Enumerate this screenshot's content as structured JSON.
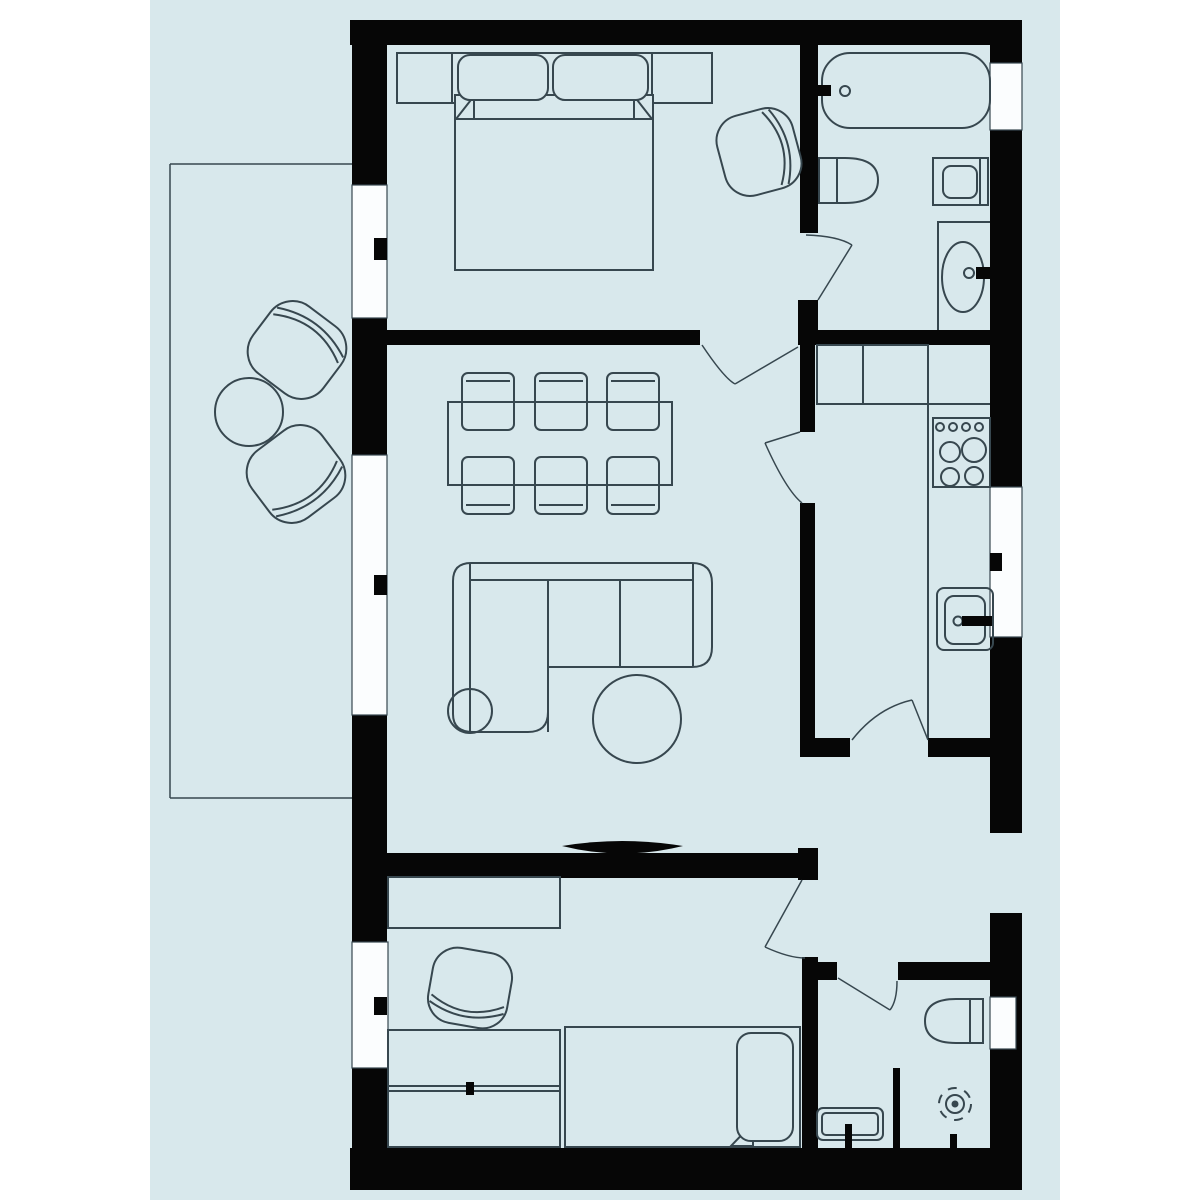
{
  "canvas": {
    "width": 1200,
    "height": 1200,
    "background": "#ffffff"
  },
  "palette": {
    "floor": "#d8e8ec",
    "wall": "#060606",
    "line": "#37474f",
    "window": "#fbfdfe",
    "stroke_furniture": 2,
    "stroke_frame": 1.5
  },
  "plan": {
    "floor_panel": {
      "x": 150,
      "y": 0,
      "w": 910,
      "h": 1200
    },
    "balcony": {
      "lines": [
        {
          "name": "balcony-edge-top",
          "x1": 170,
          "y1": 164,
          "x2": 352,
          "y2": 164
        },
        {
          "name": "balcony-edge-left",
          "x1": 170,
          "y1": 164,
          "x2": 170,
          "y2": 798
        },
        {
          "name": "balcony-edge-bottom",
          "x1": 170,
          "y1": 798,
          "x2": 352,
          "y2": 798
        }
      ]
    },
    "walls": [
      {
        "name": "wall-top",
        "x": 350,
        "y": 20,
        "w": 672,
        "h": 25
      },
      {
        "name": "wall-left-1",
        "x": 352,
        "y": 20,
        "w": 35,
        "h": 165
      },
      {
        "name": "wall-left-2",
        "x": 352,
        "y": 318,
        "w": 35,
        "h": 137
      },
      {
        "name": "wall-left-3",
        "x": 352,
        "y": 715,
        "w": 35,
        "h": 227
      },
      {
        "name": "wall-left-4",
        "x": 352,
        "y": 1068,
        "w": 36,
        "h": 92
      },
      {
        "name": "wall-bottom",
        "x": 350,
        "y": 1148,
        "w": 672,
        "h": 42
      },
      {
        "name": "wall-right-1",
        "x": 990,
        "y": 20,
        "w": 32,
        "h": 43
      },
      {
        "name": "wall-right-2",
        "x": 990,
        "y": 130,
        "w": 32,
        "h": 357
      },
      {
        "name": "wall-right-3",
        "x": 990,
        "y": 637,
        "w": 32,
        "h": 196
      },
      {
        "name": "wall-right-4",
        "x": 990,
        "y": 913,
        "w": 32,
        "h": 245
      },
      {
        "name": "wall-bedroom1-bathroom1",
        "x": 800,
        "y": 45,
        "w": 18,
        "h": 188
      },
      {
        "name": "wall-junction-block",
        "x": 798,
        "y": 300,
        "w": 20,
        "h": 45
      },
      {
        "name": "wall-livingroom-top",
        "x": 387,
        "y": 330,
        "w": 313,
        "h": 15
      },
      {
        "name": "wall-bathroom1-bottom",
        "x": 815,
        "y": 330,
        "w": 175,
        "h": 15
      },
      {
        "name": "wall-kitchen-left-upper",
        "x": 800,
        "y": 345,
        "w": 15,
        "h": 87
      },
      {
        "name": "wall-kitchen-left-lower",
        "x": 800,
        "y": 503,
        "w": 15,
        "h": 254
      },
      {
        "name": "wall-kitchen-bottom-left",
        "x": 800,
        "y": 738,
        "w": 50,
        "h": 19
      },
      {
        "name": "wall-kitchen-bottom-right",
        "x": 928,
        "y": 738,
        "w": 62,
        "h": 19
      },
      {
        "name": "wall-livingroom-bottom",
        "x": 387,
        "y": 853,
        "w": 416,
        "h": 25
      },
      {
        "name": "wall-livingroom-bottom-cap",
        "x": 798,
        "y": 848,
        "w": 20,
        "h": 32
      },
      {
        "name": "wall-bedroom2-right",
        "x": 802,
        "y": 957,
        "w": 16,
        "h": 191
      },
      {
        "name": "wall-bathroom2-top-left",
        "x": 817,
        "y": 962,
        "w": 20,
        "h": 18
      },
      {
        "name": "wall-bathroom2-top-right",
        "x": 898,
        "y": 962,
        "w": 92,
        "h": 18
      },
      {
        "name": "wall-bathroom2-partition",
        "x": 893,
        "y": 1068,
        "w": 7,
        "h": 80
      }
    ],
    "windows": [
      {
        "name": "window-bedroom1-left",
        "x": 352,
        "y": 185,
        "w": 35,
        "h": 133,
        "tick": {
          "x": 374,
          "y": 238,
          "w": 13,
          "h": 22
        }
      },
      {
        "name": "window-livingroom-left",
        "x": 352,
        "y": 455,
        "w": 35,
        "h": 260,
        "tick": {
          "x": 374,
          "y": 575,
          "w": 13,
          "h": 20
        }
      },
      {
        "name": "window-bedroom2-left",
        "x": 352,
        "y": 942,
        "w": 36,
        "h": 126,
        "tick": {
          "x": 374,
          "y": 997,
          "w": 13,
          "h": 18
        }
      },
      {
        "name": "window-bathroom1-right",
        "x": 990,
        "y": 63,
        "w": 32,
        "h": 67,
        "tick": null
      },
      {
        "name": "window-kitchen-right",
        "x": 990,
        "y": 487,
        "w": 32,
        "h": 150,
        "tick": {
          "x": 990,
          "y": 553,
          "w": 12,
          "h": 18
        }
      },
      {
        "name": "niche-toilet-bathroom2",
        "x": 990,
        "y": 997,
        "w": 26,
        "h": 52,
        "tick": null
      }
    ],
    "doors": [
      {
        "name": "door-bedroom1",
        "leaf": [
          798,
          347,
          735,
          384
        ],
        "arc": "M702 345 Q724 378 735 384"
      },
      {
        "name": "door-bathroom1",
        "leaf": [
          818,
          300,
          852,
          245
        ],
        "arc": "M806 235 Q838 236 852 245"
      },
      {
        "name": "door-kitchen-living",
        "leaf": [
          800,
          432,
          765,
          443
        ],
        "arc": "M765 443 Q786 490 802 503"
      },
      {
        "name": "door-kitchen-hallway",
        "leaf": [
          928,
          740,
          912,
          700
        ],
        "arc": "M852 740 Q877 708 912 700"
      },
      {
        "name": "door-bedroom2",
        "leaf": [
          802,
          880,
          765,
          947
        ],
        "arc": "M765 947 Q789 958 805 958"
      },
      {
        "name": "door-bathroom2",
        "leaf": [
          838,
          978,
          890,
          1010
        ],
        "arc": "M897 981 Q897 1001 890 1010"
      }
    ],
    "furniture": [
      {
        "name": "balcony-armchair-top",
        "type": "tubchair",
        "cx": 297,
        "cy": 350,
        "w": 84,
        "h": 88,
        "rot": -53
      },
      {
        "name": "balcony-armchair-bottom",
        "type": "tubchair",
        "cx": 296,
        "cy": 474,
        "w": 84,
        "h": 88,
        "rot": 53
      },
      {
        "name": "balcony-table",
        "type": "circle",
        "cx": 249,
        "cy": 412,
        "r": 34
      },
      {
        "name": "wardrobe-bedroom1",
        "type": "rect",
        "x": 397,
        "y": 53,
        "w": 315,
        "h": 50
      },
      {
        "name": "wardrobe-bedroom1-divider-1",
        "type": "line",
        "x1": 452,
        "y1": 53,
        "x2": 452,
        "y2": 103
      },
      {
        "name": "wardrobe-bedroom1-divider-2",
        "type": "line",
        "x1": 652,
        "y1": 53,
        "x2": 652,
        "y2": 103
      },
      {
        "name": "double-bed",
        "type": "rectf",
        "x": 455,
        "y": 95,
        "w": 198,
        "h": 175
      },
      {
        "name": "double-bed-blanket-line",
        "type": "line",
        "x1": 455,
        "y1": 119,
        "x2": 653,
        "y2": 119
      },
      {
        "name": "double-bed-fold-left",
        "type": "polygon",
        "points": "456,119 474,96 474,119"
      },
      {
        "name": "double-bed-fold-right",
        "type": "polygon",
        "points": "652,119 634,96 634,119"
      },
      {
        "name": "double-bed-pillow-1",
        "type": "rrectf",
        "x": 458,
        "y": 55,
        "w": 90,
        "h": 45,
        "rx": 12
      },
      {
        "name": "double-bed-pillow-2",
        "type": "rrectf",
        "x": 553,
        "y": 55,
        "w": 95,
        "h": 45,
        "rx": 12
      },
      {
        "name": "bedroom1-armchair",
        "type": "tubchair",
        "cx": 759,
        "cy": 152,
        "w": 78,
        "h": 82,
        "rot": -15
      },
      {
        "name": "bathtub",
        "type": "rrect",
        "x": 822,
        "y": 53,
        "w": 168,
        "h": 75,
        "rx": 28
      },
      {
        "name": "bathtub-faucet",
        "type": "blackrect",
        "x": 815,
        "y": 85,
        "w": 16,
        "h": 11
      },
      {
        "name": "bathtub-faucet-knob",
        "type": "circle",
        "cx": 845,
        "cy": 91,
        "r": 5
      },
      {
        "name": "toilet-bathroom1",
        "type": "path",
        "d": "M819 158 L845 158 Q878 158 878 180 Q878 203 845 203 L819 203 Z"
      },
      {
        "name": "toilet-bathroom1-cistern-line",
        "type": "line",
        "x1": 837,
        "y1": 158,
        "x2": 837,
        "y2": 203
      },
      {
        "name": "washbasin-small",
        "type": "rect",
        "x": 933,
        "y": 158,
        "w": 55,
        "h": 47
      },
      {
        "name": "washbasin-small-bowl",
        "type": "rrect",
        "x": 943,
        "y": 166,
        "w": 34,
        "h": 32,
        "rx": 8
      },
      {
        "name": "washbasin-small-line",
        "type": "line",
        "x1": 980,
        "y1": 158,
        "x2": 980,
        "y2": 205
      },
      {
        "name": "vanity-counter",
        "type": "path",
        "d": "M938 330 L938 222 L990 222"
      },
      {
        "name": "vanity-sink",
        "type": "ellipse",
        "cx": 963,
        "cy": 277,
        "rx": 21,
        "ry": 35
      },
      {
        "name": "vanity-faucet",
        "type": "blackrect",
        "x": 976,
        "y": 267,
        "w": 16,
        "h": 12
      },
      {
        "name": "vanity-faucet-knob",
        "type": "circle",
        "cx": 969,
        "cy": 273,
        "r": 5
      },
      {
        "name": "kitchen-cabinets",
        "type": "rect",
        "x": 817,
        "y": 345,
        "w": 111,
        "h": 59
      },
      {
        "name": "kitchen-cabinet-divider",
        "type": "line",
        "x1": 863,
        "y1": 345,
        "x2": 863,
        "y2": 404
      },
      {
        "name": "kitchen-counter-edge",
        "type": "line",
        "x1": 928,
        "y1": 345,
        "x2": 928,
        "y2": 738
      },
      {
        "name": "kitchen-counter-top-line",
        "type": "line",
        "x1": 928,
        "y1": 404,
        "x2": 990,
        "y2": 404
      },
      {
        "name": "stove",
        "type": "rect",
        "x": 933,
        "y": 418,
        "w": 57,
        "h": 69
      },
      {
        "name": "stove-knob-1",
        "type": "circle",
        "cx": 940,
        "cy": 427,
        "r": 4
      },
      {
        "name": "stove-knob-2",
        "type": "circle",
        "cx": 953,
        "cy": 427,
        "r": 4
      },
      {
        "name": "stove-knob-3",
        "type": "circle",
        "cx": 966,
        "cy": 427,
        "r": 4
      },
      {
        "name": "stove-knob-4",
        "type": "circle",
        "cx": 979,
        "cy": 427,
        "r": 4
      },
      {
        "name": "stove-burner-1",
        "type": "circle",
        "cx": 950,
        "cy": 452,
        "r": 10
      },
      {
        "name": "stove-burner-2",
        "type": "circle",
        "cx": 974,
        "cy": 450,
        "r": 12
      },
      {
        "name": "stove-burner-3",
        "type": "circle",
        "cx": 950,
        "cy": 477,
        "r": 9
      },
      {
        "name": "stove-burner-4",
        "type": "circle",
        "cx": 974,
        "cy": 476,
        "r": 9
      },
      {
        "name": "kitchen-sink",
        "type": "rrect",
        "x": 937,
        "y": 588,
        "w": 56,
        "h": 62,
        "rx": 7
      },
      {
        "name": "kitchen-sink-basin",
        "type": "rrect",
        "x": 945,
        "y": 596,
        "w": 40,
        "h": 48,
        "rx": 9
      },
      {
        "name": "kitchen-faucet-knob",
        "type": "circle",
        "cx": 958,
        "cy": 621,
        "r": 4.5
      },
      {
        "name": "kitchen-faucet",
        "type": "blackrect",
        "x": 962,
        "y": 616,
        "w": 30,
        "h": 10
      },
      {
        "name": "dining-chair-top-1",
        "type": "rrect",
        "x": 462,
        "y": 373,
        "w": 52,
        "h": 57,
        "rx": 6
      },
      {
        "name": "dining-chair-top-1-back",
        "type": "line",
        "x1": 466,
        "y1": 381,
        "x2": 510,
        "y2": 381
      },
      {
        "name": "dining-chair-top-2",
        "type": "rrect",
        "x": 535,
        "y": 373,
        "w": 52,
        "h": 57,
        "rx": 6
      },
      {
        "name": "dining-chair-top-2-back",
        "type": "line",
        "x1": 539,
        "y1": 381,
        "x2": 583,
        "y2": 381
      },
      {
        "name": "dining-chair-top-3",
        "type": "rrect",
        "x": 607,
        "y": 373,
        "w": 52,
        "h": 57,
        "rx": 6
      },
      {
        "name": "dining-chair-top-3-back",
        "type": "line",
        "x1": 611,
        "y1": 381,
        "x2": 655,
        "y2": 381
      },
      {
        "name": "dining-chair-bottom-1",
        "type": "rrect",
        "x": 462,
        "y": 457,
        "w": 52,
        "h": 57,
        "rx": 6
      },
      {
        "name": "dining-chair-bottom-1-back",
        "type": "line",
        "x1": 466,
        "y1": 505,
        "x2": 510,
        "y2": 505
      },
      {
        "name": "dining-chair-bottom-2",
        "type": "rrect",
        "x": 535,
        "y": 457,
        "w": 52,
        "h": 57,
        "rx": 6
      },
      {
        "name": "dining-chair-bottom-2-back",
        "type": "line",
        "x1": 539,
        "y1": 505,
        "x2": 583,
        "y2": 505
      },
      {
        "name": "dining-chair-bottom-3",
        "type": "rrect",
        "x": 607,
        "y": 457,
        "w": 52,
        "h": 57,
        "rx": 6
      },
      {
        "name": "dining-chair-bottom-3-back",
        "type": "line",
        "x1": 611,
        "y1": 505,
        "x2": 655,
        "y2": 505
      },
      {
        "name": "dining-table",
        "type": "rect",
        "x": 448,
        "y": 402,
        "w": 224,
        "h": 83
      },
      {
        "name": "sofa-outline",
        "type": "pathf",
        "d": "M453 714 L453 581 Q453 563 471 563 L692 563 Q712 563 712 583 L712 647 Q712 667 692 667 L548 667 L548 712 Q548 732 528 732 L473 732 Q453 732 453 714 Z"
      },
      {
        "name": "sofa-back-line",
        "type": "line",
        "x1": 470,
        "y1": 580,
        "x2": 693,
        "y2": 580
      },
      {
        "name": "sofa-left-arm-line",
        "type": "line",
        "x1": 470,
        "y1": 563,
        "x2": 470,
        "y2": 732
      },
      {
        "name": "sofa-chaise-edge",
        "type": "line",
        "x1": 548,
        "y1": 580,
        "x2": 548,
        "y2": 732
      },
      {
        "name": "sofa-cushion-divider",
        "type": "line",
        "x1": 620,
        "y1": 580,
        "x2": 620,
        "y2": 667
      },
      {
        "name": "sofa-right-arm-line",
        "type": "line",
        "x1": 693,
        "y1": 563,
        "x2": 693,
        "y2": 667
      },
      {
        "name": "side-table",
        "type": "circle",
        "cx": 470,
        "cy": 711,
        "r": 22
      },
      {
        "name": "coffee-table",
        "type": "circle",
        "cx": 637,
        "cy": 719,
        "r": 44
      },
      {
        "name": "tv",
        "type": "blackpath",
        "d": "M562 846 Q622 836 683 846 Q622 861 562 846 Z"
      },
      {
        "name": "tv-stand",
        "type": "blackrect",
        "x": 618,
        "y": 851,
        "w": 12,
        "h": 15
      },
      {
        "name": "desk-bedroom2",
        "type": "rect",
        "x": 388,
        "y": 877,
        "w": 172,
        "h": 51
      },
      {
        "name": "bedroom2-armchair",
        "type": "tubchair",
        "cx": 470,
        "cy": 988,
        "w": 76,
        "h": 80,
        "rot": 100
      },
      {
        "name": "wardrobe-bedroom2",
        "type": "rect",
        "x": 388,
        "y": 1030,
        "w": 172,
        "h": 117
      },
      {
        "name": "wardrobe-bedroom2-line-1",
        "type": "line",
        "x1": 388,
        "y1": 1086,
        "x2": 560,
        "y2": 1086
      },
      {
        "name": "wardrobe-bedroom2-line-2",
        "type": "line",
        "x1": 388,
        "y1": 1091,
        "x2": 560,
        "y2": 1091
      },
      {
        "name": "wardrobe-bedroom2-handle",
        "type": "blackrect",
        "x": 466,
        "y": 1082,
        "w": 8,
        "h": 13
      },
      {
        "name": "single-bed",
        "type": "rectf",
        "x": 565,
        "y": 1027,
        "w": 235,
        "h": 120
      },
      {
        "name": "single-bed-fold",
        "type": "polygon",
        "points": "731,1146 753,1123 753,1146"
      },
      {
        "name": "single-bed-pillow",
        "type": "rrectf",
        "x": 737,
        "y": 1033,
        "w": 56,
        "h": 108,
        "rx": 14
      },
      {
        "name": "toilet-bathroom2",
        "type": "path",
        "d": "M983 999 L956 999 Q925 999 925 1021 Q925 1043 956 1043 L983 1043 Z"
      },
      {
        "name": "toilet-bathroom2-cistern-line",
        "type": "line",
        "x1": 970,
        "y1": 999,
        "x2": 970,
        "y2": 1043
      },
      {
        "name": "shower-drain-outer",
        "type": "dashedcircle",
        "cx": 955,
        "cy": 1104,
        "r": 16
      },
      {
        "name": "shower-drain-ring",
        "type": "circle",
        "cx": 955,
        "cy": 1104,
        "r": 9
      },
      {
        "name": "shower-drain-dot",
        "type": "dotcircle",
        "cx": 955,
        "cy": 1104,
        "r": 3.5
      },
      {
        "name": "washbasin-bathroom2",
        "type": "rrect",
        "x": 817,
        "y": 1108,
        "w": 66,
        "h": 32,
        "rx": 6
      },
      {
        "name": "washbasin-bathroom2-inner",
        "type": "rrect",
        "x": 822,
        "y": 1113,
        "w": 56,
        "h": 22,
        "rx": 4
      },
      {
        "name": "washbasin-bathroom2-tap",
        "type": "blackrect",
        "x": 845,
        "y": 1124,
        "w": 7,
        "h": 26
      },
      {
        "name": "shower-tap",
        "type": "blackrect",
        "x": 950,
        "y": 1134,
        "w": 7,
        "h": 14
      }
    ]
  }
}
